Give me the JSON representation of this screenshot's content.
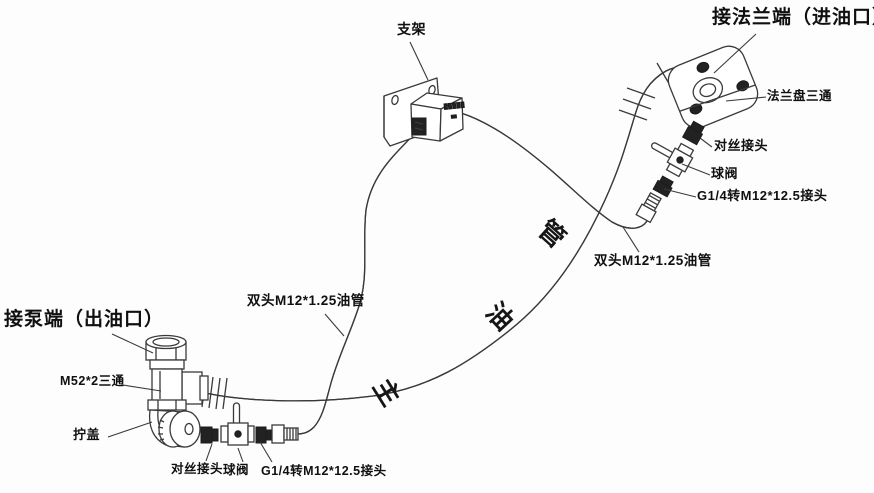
{
  "drawing": {
    "background": "#fdfdfd",
    "line_color": "#3a3a3a",
    "fitting_dark_color": "#222222",
    "text_color": "#101010",
    "labels": {
      "bracket": "支架",
      "flange_end_title": "接法兰端（进油口）",
      "flange_tee": "法兰盘三通",
      "right_threaded_joint": "对丝接头",
      "right_ball_valve": "球阀",
      "right_adapter": "G1/4转M12*12.5接头",
      "right_oil_pipe": "双头M12*1.25油管",
      "left_oil_pipe": "双头M12*1.25油管",
      "pump_end_title": "接泵端（出油口）",
      "tee": "M52*2三通",
      "screw_cap": "拧盖",
      "bottom_threaded_joint": "对丝接头",
      "bottom_ball_valve": "球阀",
      "bottom_adapter": "G1/4转M12*12.5接头",
      "main_pipe": "主油管",
      "main_pipe_chars": [
        "主",
        "油",
        "管"
      ]
    }
  }
}
